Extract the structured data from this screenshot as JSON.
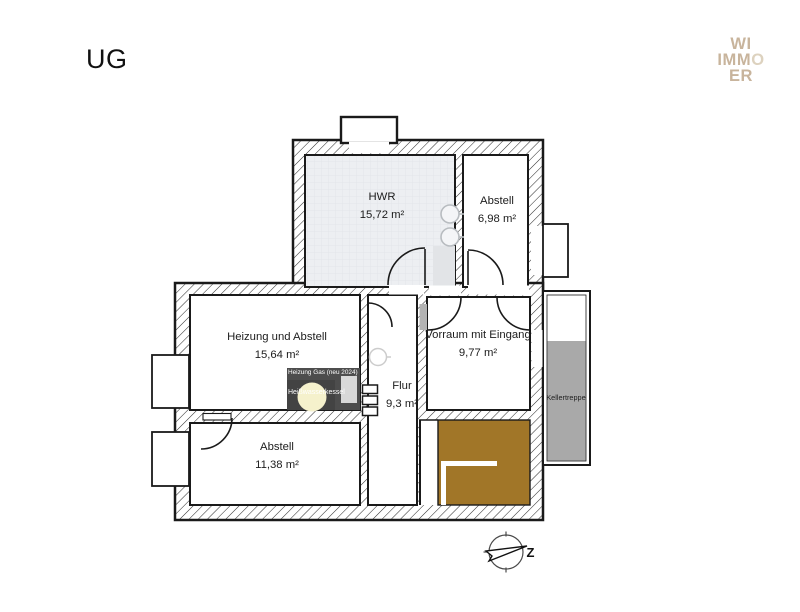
{
  "page": {
    "title": "UG"
  },
  "logo": {
    "line1": "WI",
    "line2_strong": "IMM",
    "line2_light": "O",
    "line3": "ER"
  },
  "rooms": {
    "hwr": {
      "name": "HWR",
      "area": "15,72 m²"
    },
    "abstell_top": {
      "name": "Abstell",
      "area": "6,98 m²"
    },
    "heizung": {
      "name": "Heizung und Abstell",
      "area": "15,64 m²"
    },
    "vorraum": {
      "name": "Vorraum mit Eingang",
      "area": "9,77 m²"
    },
    "flur": {
      "name": "Flur",
      "area": "9,3 m²"
    },
    "abstell_bottom": {
      "name": "Abstell",
      "area": "11,38 m²"
    },
    "kellertreppe": {
      "name": "Kellertreppe"
    }
  },
  "annotations": {
    "heizung_gas": "Heizung Gas (neu 2024)",
    "kessel": "Heißwasserkessel"
  },
  "compass": {
    "label": "Z"
  },
  "colors": {
    "wall_line": "#1a1a1a",
    "stairs_brown": "#a17628",
    "kellertreppe_gray": "#a9a9a9",
    "equipment_dark": "#4d4d4d",
    "boiler_yellow": "#f5f1cc",
    "hwr_floor": "#edeff2",
    "logo_tan": "#c8b49c"
  }
}
